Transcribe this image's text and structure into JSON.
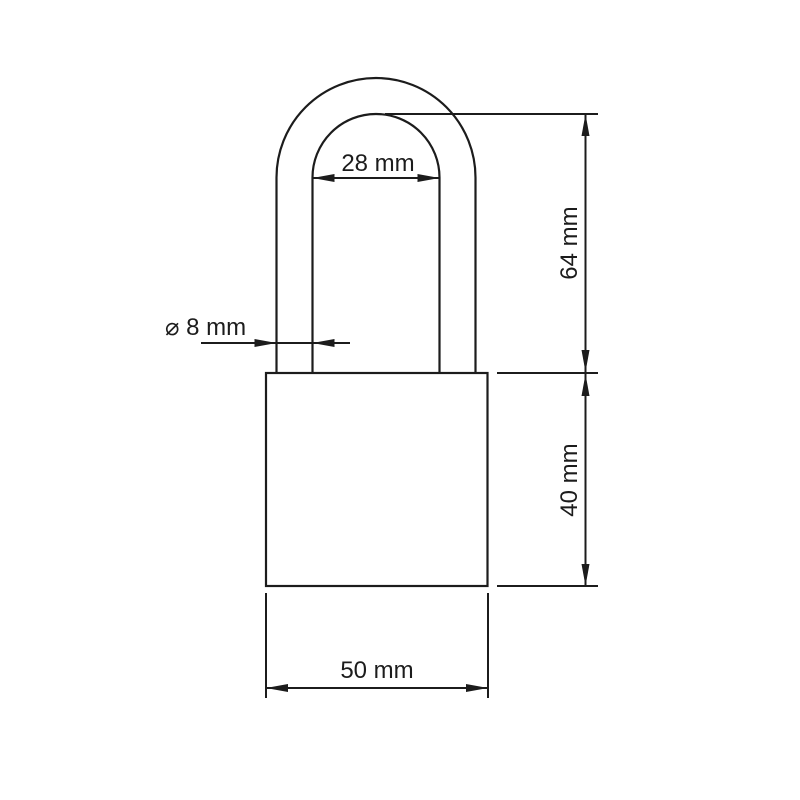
{
  "figure": {
    "type": "technical-drawing",
    "subject": "padlock with dimension annotations",
    "background": "#ffffff",
    "line_color": "#1c1c1c"
  },
  "dimensions": {
    "shackle_inner_width": {
      "label": "28 mm",
      "value": 28,
      "unit": "mm"
    },
    "shackle_wire_diameter": {
      "label": "⌀ 8 mm",
      "value": 8,
      "unit": "mm"
    },
    "shackle_height": {
      "label": "64 mm",
      "value": 64,
      "unit": "mm"
    },
    "body_height": {
      "label": "40 mm",
      "value": 40,
      "unit": "mm"
    },
    "body_width": {
      "label": "50 mm",
      "value": 50,
      "unit": "mm"
    }
  }
}
